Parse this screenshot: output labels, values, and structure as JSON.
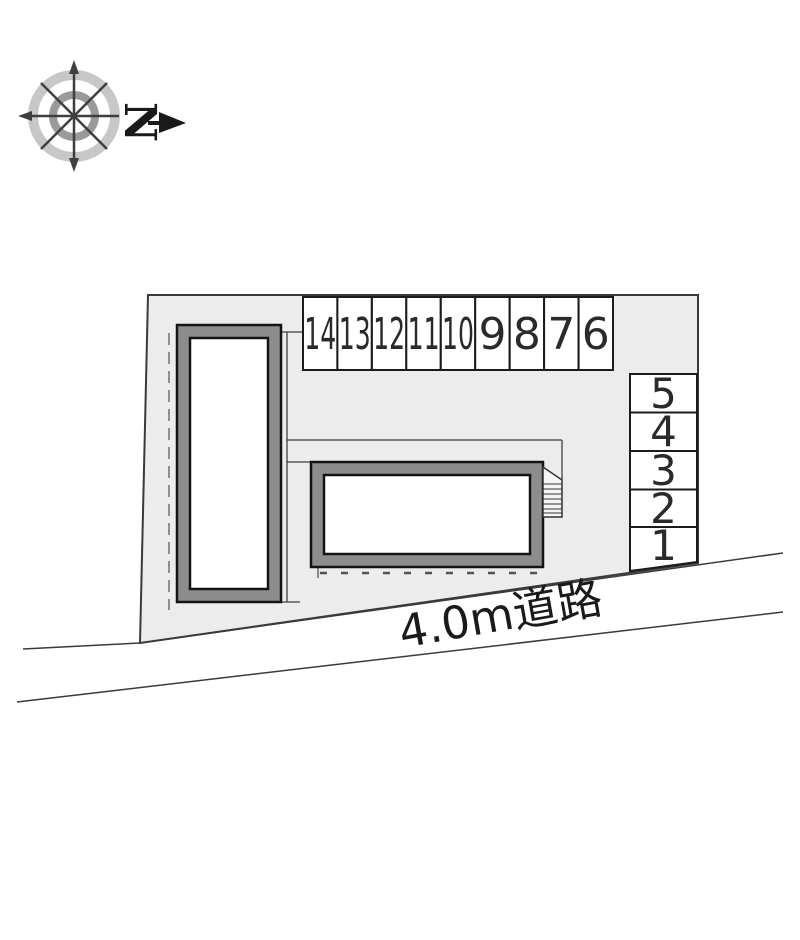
{
  "compass": {
    "north_label": "N"
  },
  "road": {
    "label": "4.0m道路"
  },
  "parking": {
    "top_row": [
      "14",
      "13",
      "12",
      "11",
      "10",
      "9",
      "8",
      "7",
      "6"
    ],
    "right_column": [
      "5",
      "4",
      "3",
      "2",
      "1"
    ]
  },
  "colors": {
    "site_fill": "#ececec",
    "stall_fill": "#ffffff",
    "building_band": "#8d8d8d",
    "outline_dark": "#1b1b1b",
    "boundary_line": "#3a3a3a",
    "dashed_gray": "#8f8f8f",
    "compass_outer_ring": "#c7c7c7",
    "compass_inner_ring": "#9a9a9a",
    "compass_spoke": "#3f3f3f"
  }
}
